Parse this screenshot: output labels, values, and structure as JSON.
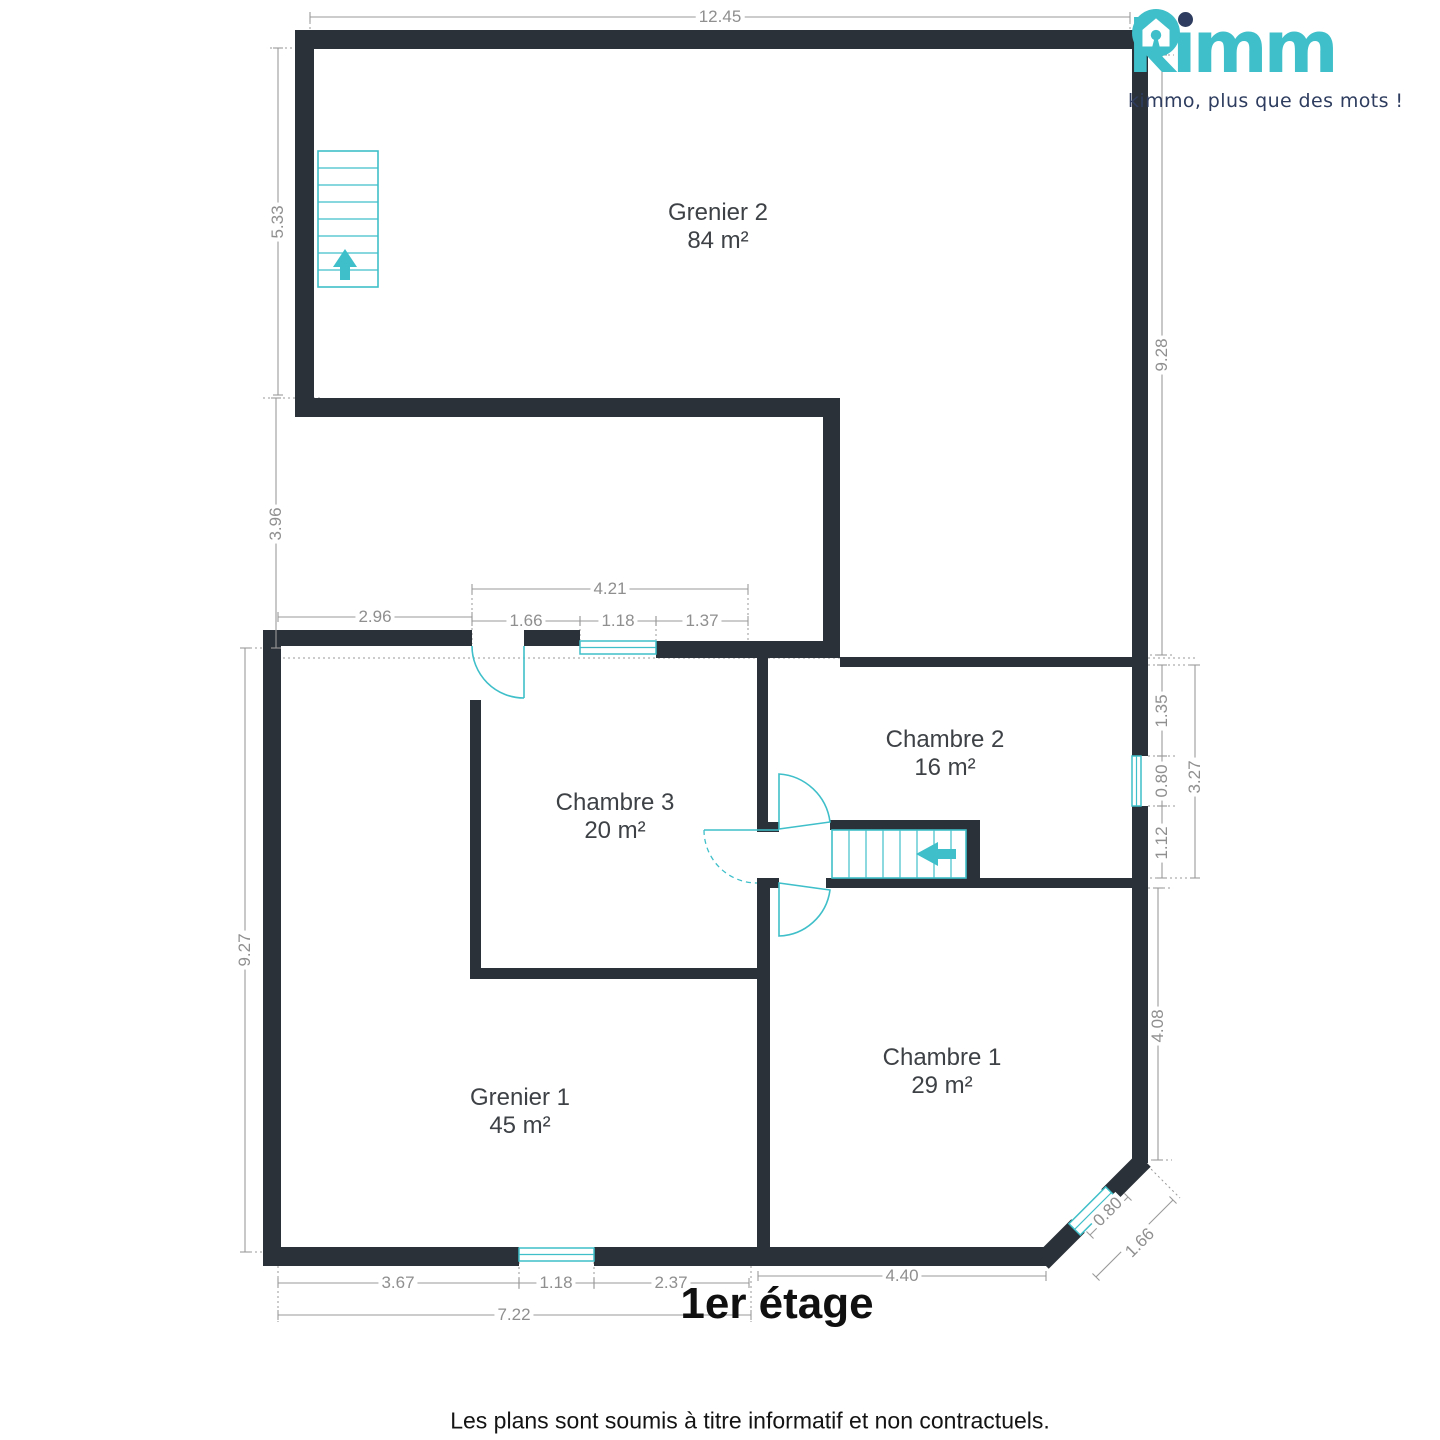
{
  "logo": {
    "brand": "kimmo",
    "tagline": "kimmo, plus que des mots !"
  },
  "plan": {
    "title": "1er étage"
  },
  "footer": {
    "disclaimer": "Les plans sont soumis à titre informatif et non contractuels."
  },
  "rooms": [
    {
      "name": "Grenier 2",
      "area": "84 m²"
    },
    {
      "name": "Chambre 2",
      "area": "16 m²"
    },
    {
      "name": "Chambre 3",
      "area": "20 m²"
    },
    {
      "name": "Grenier 1",
      "area": "45 m²"
    },
    {
      "name": "Chambre 1",
      "area": "29 m²"
    }
  ],
  "dimensions": {
    "top_width": "12.45",
    "left_upper": "5.33",
    "left_mid": "3.96",
    "left_lower": "9.27",
    "right_upper": "9.28",
    "mid_left": "2.96",
    "mid_total": "4.21",
    "mid_a": "1.66",
    "mid_b": "1.18",
    "mid_c": "1.37",
    "right_a": "1.35",
    "right_b": "0.80",
    "right_c": "1.12",
    "right_total": "3.27",
    "right_lower": "4.08",
    "diag_a": "0.80",
    "diag_b": "1.66",
    "bottom_right": "4.40",
    "bottom_a": "3.67",
    "bottom_b": "1.18",
    "bottom_c": "2.37",
    "bottom_total": "7.22"
  },
  "colors": {
    "wall": "#2b3138",
    "accent": "#3fbfc9",
    "dimension": "#9a9a9a",
    "navy": "#2e3d5f",
    "text": "#3e4246"
  }
}
